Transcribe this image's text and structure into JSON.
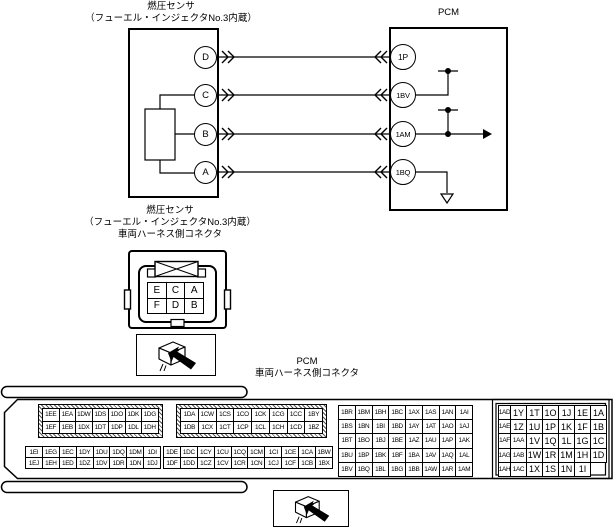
{
  "sensor": {
    "title_line1": "燃圧センサ",
    "title_line2": "（フューエル・インジェクタNo.3内蔵）",
    "terminals": [
      {
        "label": "D"
      },
      {
        "label": "C"
      },
      {
        "label": "B"
      },
      {
        "label": "A"
      }
    ]
  },
  "pcm": {
    "title": "PCM",
    "terminals": [
      {
        "label": "1P"
      },
      {
        "label": "1BV"
      },
      {
        "label": "1AM"
      },
      {
        "label": "1BQ"
      }
    ]
  },
  "harness_connector": {
    "title_line1": "燃圧センサ",
    "title_line2": "（フューエル・インジェクタNo.3内蔵）",
    "title_line3": "車両ハーネス側コネクタ",
    "pin_rows": [
      [
        "E",
        "C",
        "A"
      ],
      [
        "F",
        "D",
        "B"
      ]
    ]
  },
  "pcm_connector": {
    "title_line1": "PCM",
    "title_line2": "車両ハーネス側コネクタ",
    "blocks": {
      "hatch_a": [
        [
          "1EE",
          "1EA",
          "1DW",
          "1DS",
          "1DO",
          "1DK",
          "1DG"
        ],
        [
          "1EF",
          "1EB",
          "1DX",
          "1DT",
          "1DP",
          "1DL",
          "1DH"
        ]
      ],
      "hatch_b": [
        [
          "1DA",
          "1CW",
          "1CS",
          "1CO",
          "1CK",
          "1CG",
          "1CC",
          "1BY"
        ],
        [
          "1DB",
          "1CX",
          "1CT",
          "1CP",
          "1CL",
          "1CH",
          "1CD",
          "1BZ"
        ]
      ],
      "main": [
        [
          "1BR",
          "1BM",
          "1BH",
          "1BC",
          "1AX",
          "1AS",
          "1AN",
          "1AI"
        ],
        [
          "1BS",
          "1BN",
          "1BI",
          "1BD",
          "1AY",
          "1AT",
          "1AO",
          "1AJ"
        ],
        [
          "1BT",
          "1BO",
          "1BJ",
          "1BE",
          "1AZ",
          "1AU",
          "1AP",
          "1AK"
        ],
        [
          "1BU",
          "1BP",
          "1BK",
          "1BF",
          "1BA",
          "1AV",
          "1AQ",
          "1AL"
        ],
        [
          "1BV",
          "1BQ",
          "1BL",
          "1BG",
          "1BB",
          "1AW",
          "1AR",
          "1AM"
        ]
      ],
      "right": [
        [
          "1AD",
          "1Y",
          "1T",
          "1O",
          "1J",
          "1E",
          "1A"
        ],
        [
          "1AE",
          "1Z",
          "1U",
          "1P",
          "1K",
          "1F",
          "1B"
        ],
        [
          "1AF",
          "1AA",
          "1V",
          "1Q",
          "1L",
          "1G",
          "1C"
        ],
        [
          "1AG",
          "1AB",
          "1W",
          "1R",
          "1M",
          "1H",
          "1D"
        ],
        [
          "1AH",
          "1AC",
          "1X",
          "1S",
          "1N",
          "1I"
        ]
      ],
      "lower_a": [
        [
          "1EI",
          "1EG",
          "1EC",
          "1DY",
          "1DU",
          "1DQ",
          "1DM",
          "1DI"
        ],
        [
          "1EJ",
          "1EH",
          "1ED",
          "1DZ",
          "1DV",
          "1DR",
          "1DN",
          "1DJ"
        ]
      ],
      "lower_b": [
        [
          "1DE",
          "1DC",
          "1CY",
          "1CU",
          "1CQ",
          "1CM",
          "1CI",
          "1CE",
          "1CA",
          "1BW"
        ],
        [
          "1DF",
          "1DD",
          "1CZ",
          "1CV",
          "1CR",
          "1CN",
          "1CJ",
          "1CF",
          "1CB",
          "1BX"
        ]
      ]
    }
  },
  "colors": {
    "line": "#000000",
    "background": "#ffffff"
  }
}
